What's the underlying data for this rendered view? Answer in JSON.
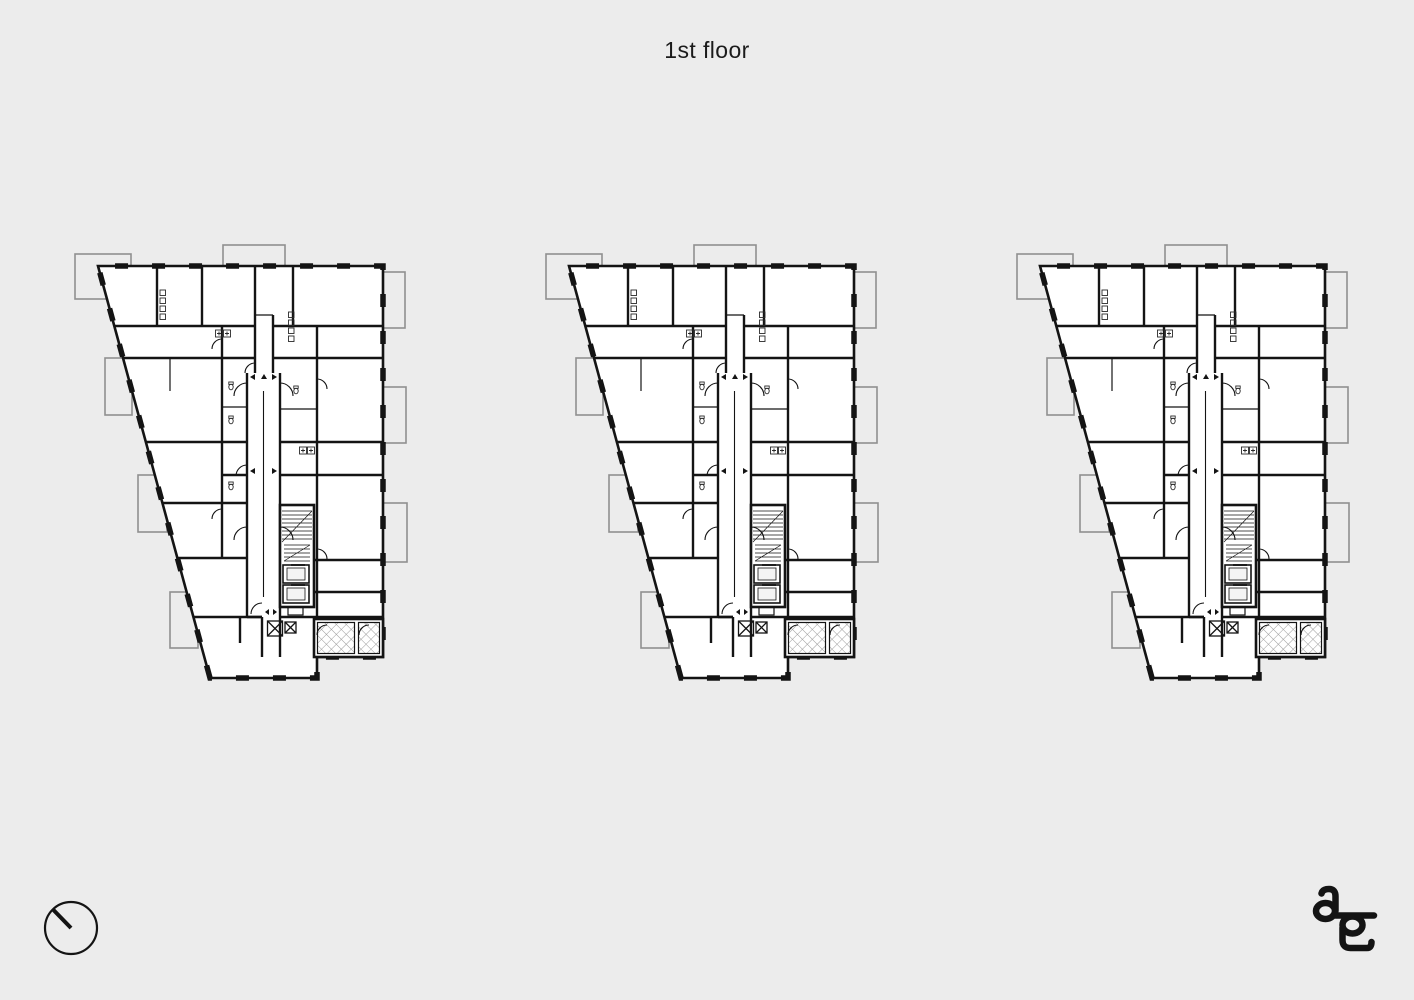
{
  "page": {
    "title": "1st floor"
  },
  "colors": {
    "background": "#ececec",
    "plan_fill": "#ffffff",
    "wall": "#141414",
    "balcony_outline": "#8f8f8f",
    "hatch_line": "#9b9b9b",
    "text": "#1b1b1b"
  },
  "figures": [
    {
      "name": "floor-plan-left"
    },
    {
      "name": "floor-plan-center"
    },
    {
      "name": "floor-plan-right"
    }
  ],
  "footer": {
    "compass": "north-arrow-icon",
    "logo": "ag-monogram-logo"
  }
}
